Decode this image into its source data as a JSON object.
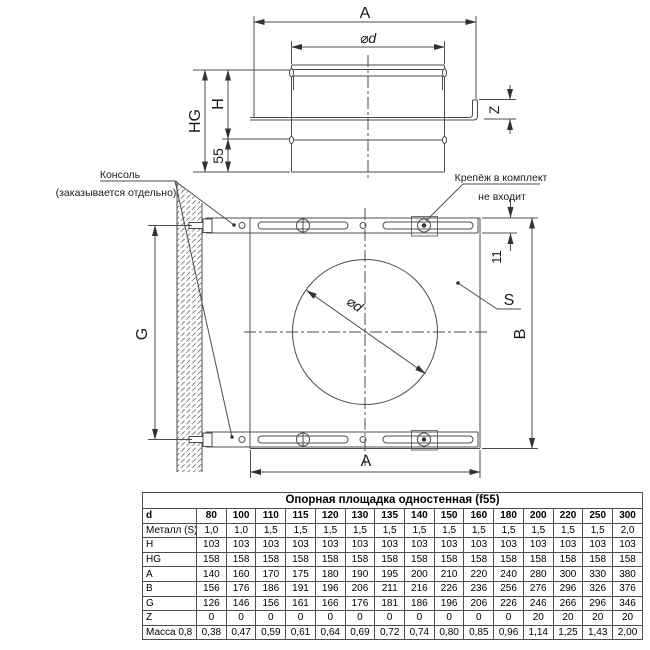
{
  "drawing": {
    "labels": {
      "A": "A",
      "phi_d": "⌀d",
      "H": "H",
      "HG": "HG",
      "fifty_five": "55",
      "Z": "Z",
      "G": "G",
      "B": "B",
      "S": "S",
      "eleven": "11"
    },
    "annotations": {
      "console_line1": "Консоль",
      "console_line2": "(заказывается отдельно)",
      "fasteners_line1": "Крепёж в комплект",
      "fasteners_line2": "не входит"
    },
    "colors": {
      "line": "#4d4d4d",
      "text": "#1a1a1a",
      "arrow": "#333333"
    }
  },
  "table": {
    "title": "Опорная площадка одностенная (f55)",
    "header": {
      "label": "d",
      "values": [
        "80",
        "100",
        "110",
        "115",
        "120",
        "130",
        "135",
        "140",
        "150",
        "160",
        "180",
        "200",
        "220",
        "250",
        "300"
      ]
    },
    "rows": [
      {
        "label": "Металл (S)",
        "values": [
          "1,0",
          "1,0",
          "1,5",
          "1,5",
          "1,5",
          "1,5",
          "1,5",
          "1,5",
          "1,5",
          "1,5",
          "1,5",
          "1,5",
          "1,5",
          "1,5",
          "2,0"
        ]
      },
      {
        "label": "H",
        "values": [
          "103",
          "103",
          "103",
          "103",
          "103",
          "103",
          "103",
          "103",
          "103",
          "103",
          "103",
          "103",
          "103",
          "103",
          "103"
        ]
      },
      {
        "label": "HG",
        "values": [
          "158",
          "158",
          "158",
          "158",
          "158",
          "158",
          "158",
          "158",
          "158",
          "158",
          "158",
          "158",
          "158",
          "158",
          "158"
        ]
      },
      {
        "label": "A",
        "values": [
          "140",
          "160",
          "170",
          "175",
          "180",
          "190",
          "195",
          "200",
          "210",
          "220",
          "240",
          "280",
          "300",
          "330",
          "380"
        ]
      },
      {
        "label": "B",
        "values": [
          "156",
          "176",
          "186",
          "191",
          "196",
          "206",
          "211",
          "216",
          "226",
          "236",
          "256",
          "276",
          "296",
          "326",
          "376"
        ]
      },
      {
        "label": "G",
        "values": [
          "126",
          "146",
          "156",
          "161",
          "166",
          "176",
          "181",
          "186",
          "196",
          "206",
          "226",
          "246",
          "266",
          "296",
          "346"
        ]
      },
      {
        "label": "Z",
        "values": [
          "0",
          "0",
          "0",
          "0",
          "0",
          "0",
          "0",
          "0",
          "0",
          "0",
          "0",
          "20",
          "20",
          "20",
          "20"
        ]
      },
      {
        "label": "Масса 0,8",
        "values": [
          "0,38",
          "0,47",
          "0,59",
          "0,61",
          "0,64",
          "0,69",
          "0,72",
          "0,74",
          "0,80",
          "0,85",
          "0,96",
          "1,14",
          "1,25",
          "1,43",
          "2,00"
        ]
      }
    ]
  }
}
